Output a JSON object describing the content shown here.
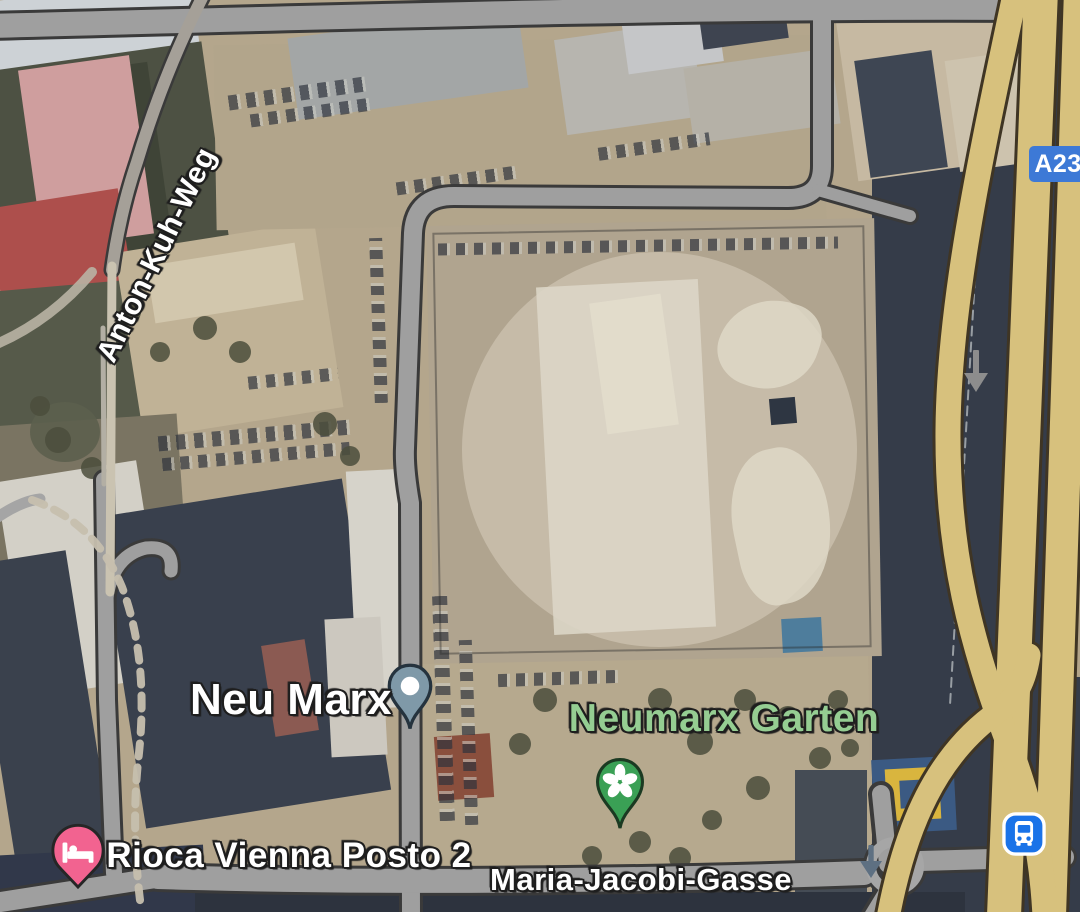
{
  "map": {
    "view": "satellite",
    "labels": {
      "district": "Neu Marx",
      "park": "Neumarx Garten",
      "hotel": "Rioca Vienna Posto 2",
      "road_bottom": "Maria-Jacobi-Gasse",
      "road_left": "Anton-Kuh-Weg",
      "highway_badge": "A23"
    },
    "markers": [
      {
        "name": "district-pin",
        "label": "Neu Marx",
        "color": "#7f99a8",
        "icon": "dot-icon"
      },
      {
        "name": "park-pin",
        "label": "Neumarx Garten",
        "color": "#3aa055",
        "icon": "flower-icon"
      },
      {
        "name": "hotel-pin",
        "label": "Rioca Vienna Posto 2",
        "color": "#f26390",
        "icon": "bed-icon"
      },
      {
        "name": "bus-station",
        "color": "#1a73e8",
        "icon": "bus-icon"
      }
    ],
    "colors": {
      "road_fill": "#9f9f9f",
      "road_outline": "#3a3a3a",
      "highway_fill": "#d7c17d",
      "highway_outline": "#3f3524",
      "badge_blue": "#3d79d6",
      "transit_blue": "#1a73e8",
      "park_label_green": "#95cd92",
      "label_white": "#ffffff",
      "label_outline": "#1f1f1f"
    }
  }
}
